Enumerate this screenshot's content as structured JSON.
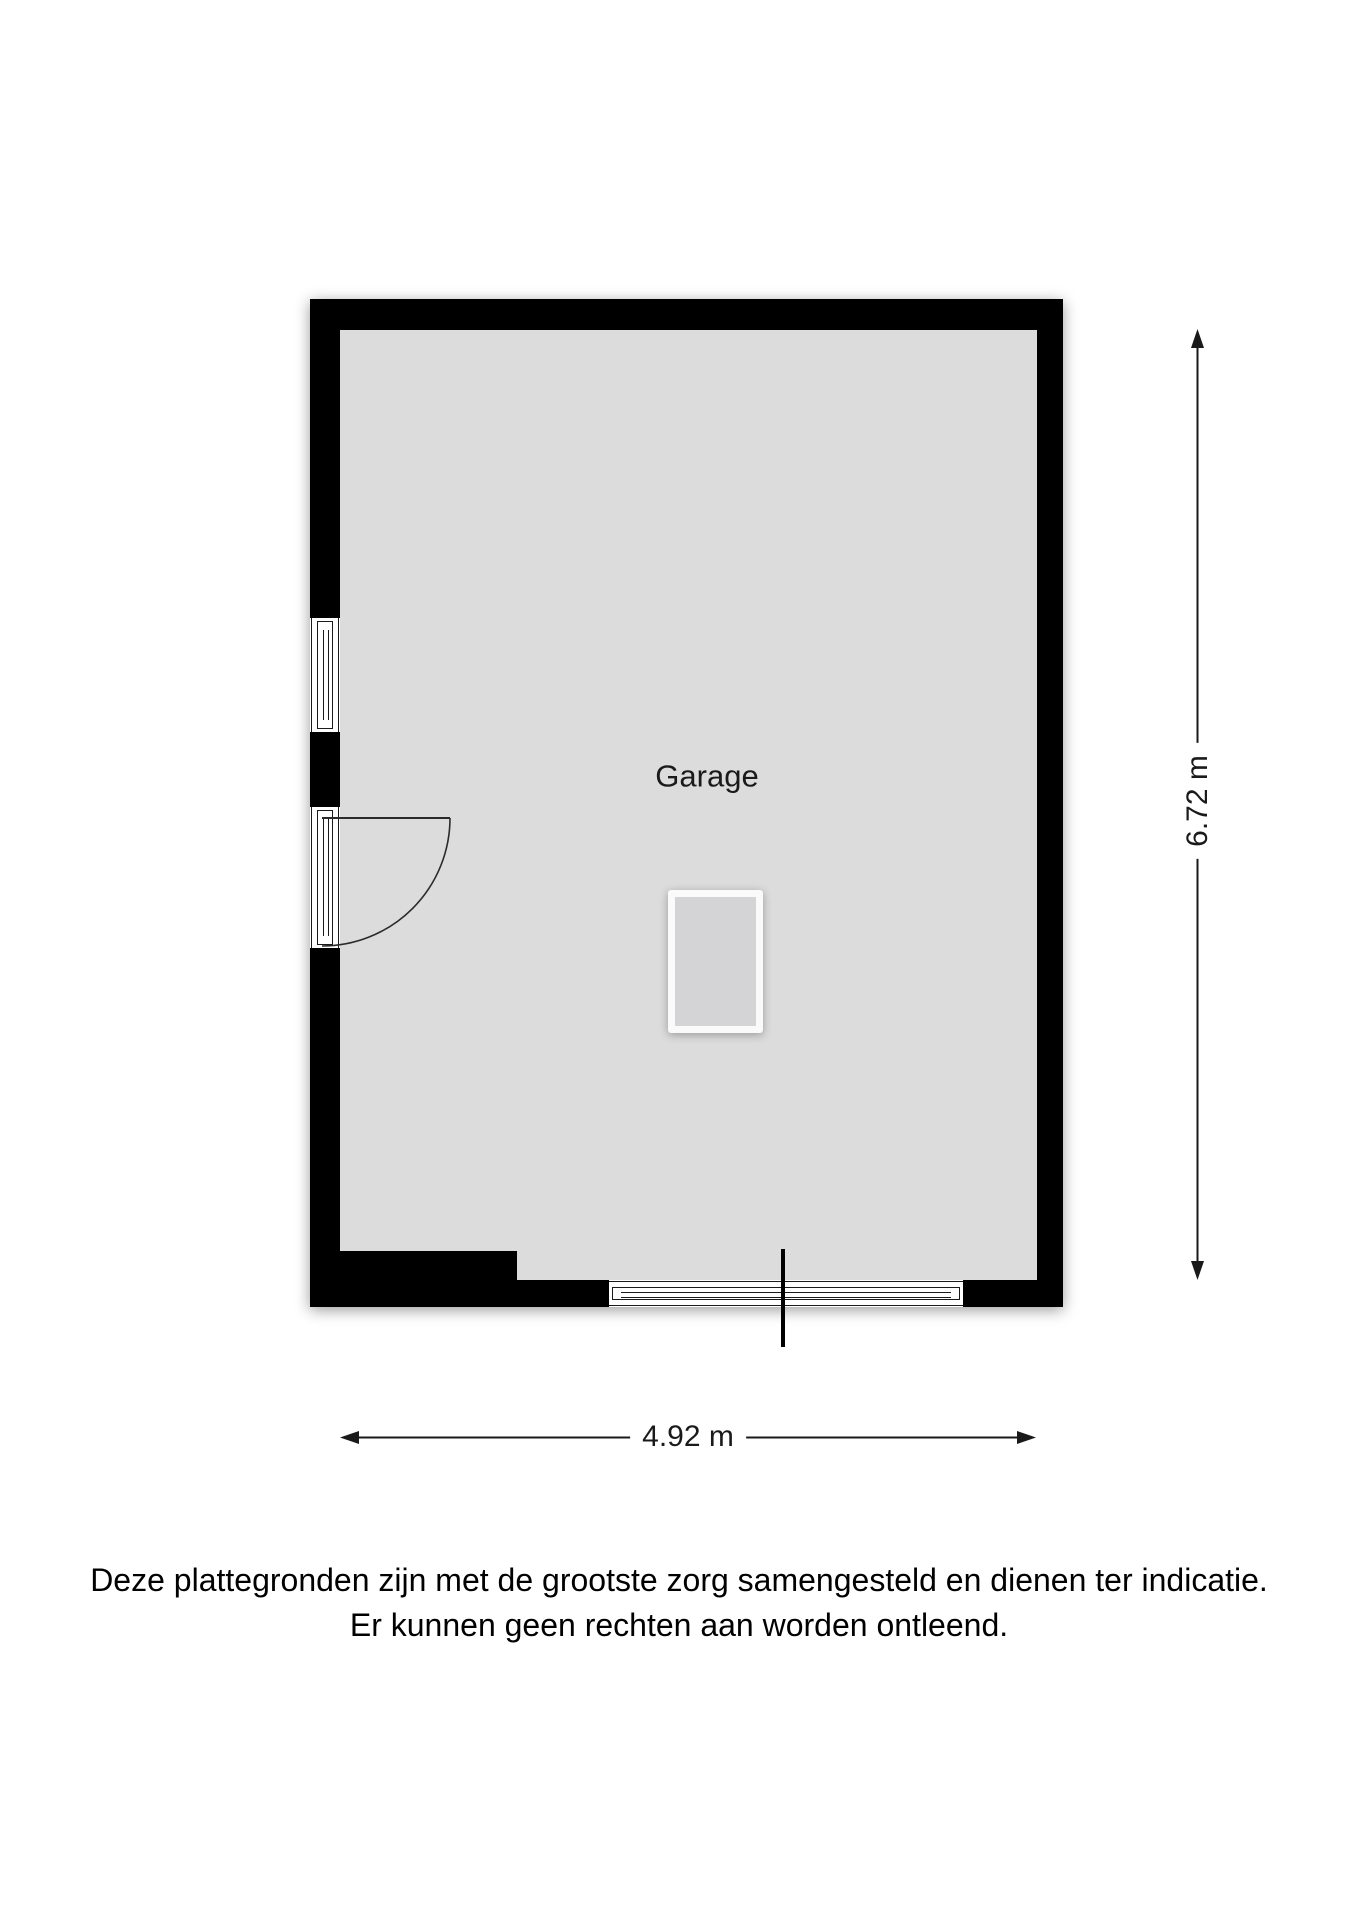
{
  "plan": {
    "room_label": "Garage",
    "dim_vertical": "6.72 m",
    "dim_horizontal": "4.92 m"
  },
  "disclaimer": {
    "line1": "Deze plattegronden zijn met de grootste zorg samengesteld en dienen ter indicatie.",
    "line2": "Er kunnen geen rechten aan worden ontleend."
  },
  "colors": {
    "wall": "#000000",
    "floor": "#dcdcdd",
    "background": "#ffffff",
    "line": "#1a1a1a"
  }
}
